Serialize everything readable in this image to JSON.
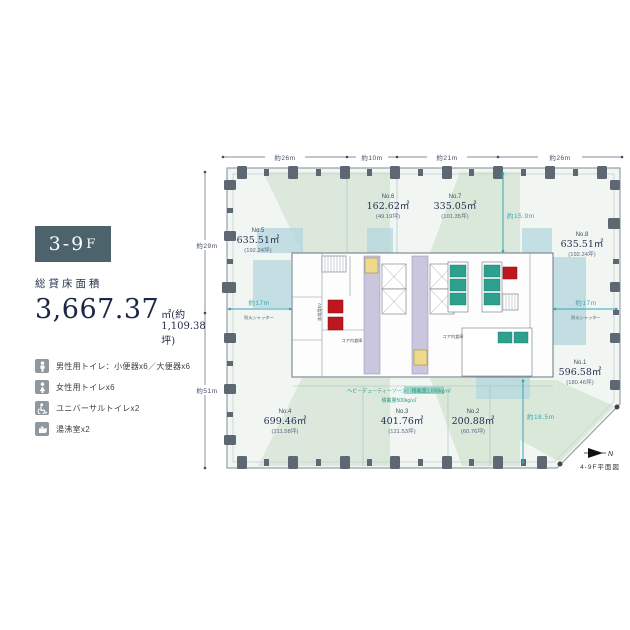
{
  "panel": {
    "badge": {
      "main": "3-9",
      "suffix": "F",
      "bg": "#4d636b"
    },
    "area_label": "総貸床面積",
    "area_value": "3,667.37",
    "area_unit": "㎡(約1,109.38坪)",
    "facilities": [
      {
        "icon": "male-icon",
        "label": "男性用トイレ：小便器x6／大便器x6"
      },
      {
        "icon": "female-icon",
        "label": "女性用トイレx6"
      },
      {
        "icon": "wheelchair-icon",
        "label": "ユニバーサルトイレx2"
      },
      {
        "icon": "kettle-icon",
        "label": "湯沸室x2"
      }
    ]
  },
  "plan": {
    "caption": "4-9F平面図",
    "compass_n": "N",
    "dims": {
      "top": [
        "約26m",
        "約10m",
        "約21m",
        "約26m"
      ],
      "left": [
        "約29m",
        "約51m"
      ],
      "inner_v1": "約15.9m",
      "inner_v2": "約18.5m",
      "inner_h_left": "約17m",
      "inner_h_right": "約17m"
    },
    "fire_shutter": "防火シャッター",
    "heavy_duty": "ヘビーデューティーゾーン：積載量1,000kg/㎡",
    "load": "積載量500kg/㎡",
    "core_storage": "コア内倉庫",
    "ev_label": "非常用EV",
    "units": [
      {
        "no": "No.1",
        "area": "596.58㎡",
        "tsubo": "(180.46坪)"
      },
      {
        "no": "No.2",
        "area": "200.88㎡",
        "tsubo": "(60.76坪)"
      },
      {
        "no": "No.3",
        "area": "401.76㎡",
        "tsubo": "(121.53坪)"
      },
      {
        "no": "No.4",
        "area": "699.46㎡",
        "tsubo": "(211.58坪)"
      },
      {
        "no": "No.5",
        "area": "635.51㎡",
        "tsubo": "(192.24坪)"
      },
      {
        "no": "No.6",
        "area": "162.62㎡",
        "tsubo": "(49.19坪)"
      },
      {
        "no": "No.7",
        "area": "335.05㎡",
        "tsubo": "(101.35坪)"
      },
      {
        "no": "No.8",
        "area": "635.51㎡",
        "tsubo": "(192.24坪)"
      }
    ],
    "colors": {
      "accent_teal": "#3aa4b4",
      "green_zone": "#c8ddc6",
      "blue_zone": "#b4d7de",
      "red_box": "#bf1620",
      "teal_box": "#2da08e",
      "lavender": "#c9c6dd",
      "yellow": "#eed98c"
    }
  }
}
